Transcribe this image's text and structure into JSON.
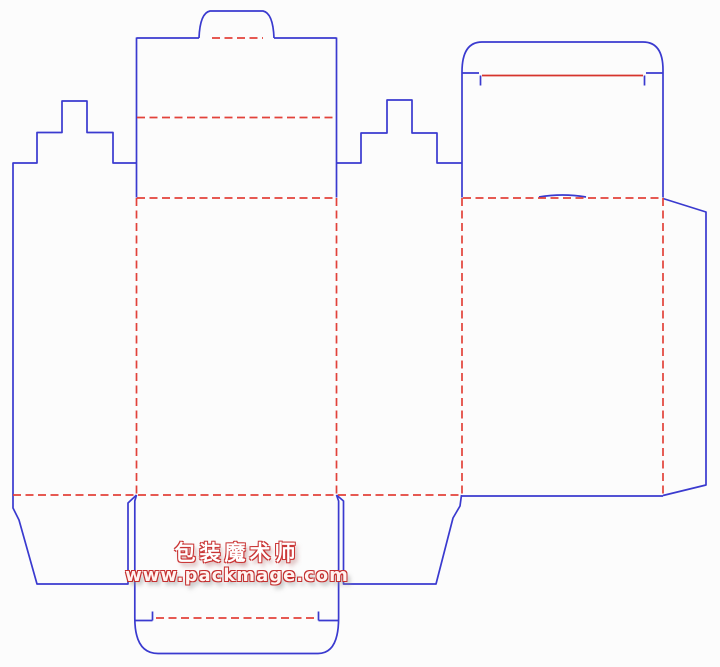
{
  "watermark": {
    "brand": "包装魔术师",
    "website": "www.packmage.com"
  },
  "colors": {
    "cut_line": "#3A3ACF",
    "crease_line": "#E2423A",
    "tear_line": "#D6342C",
    "background": "#FCFCFC",
    "watermark_outline": "#C93434",
    "watermark_fill": "#FFFFFF"
  }
}
